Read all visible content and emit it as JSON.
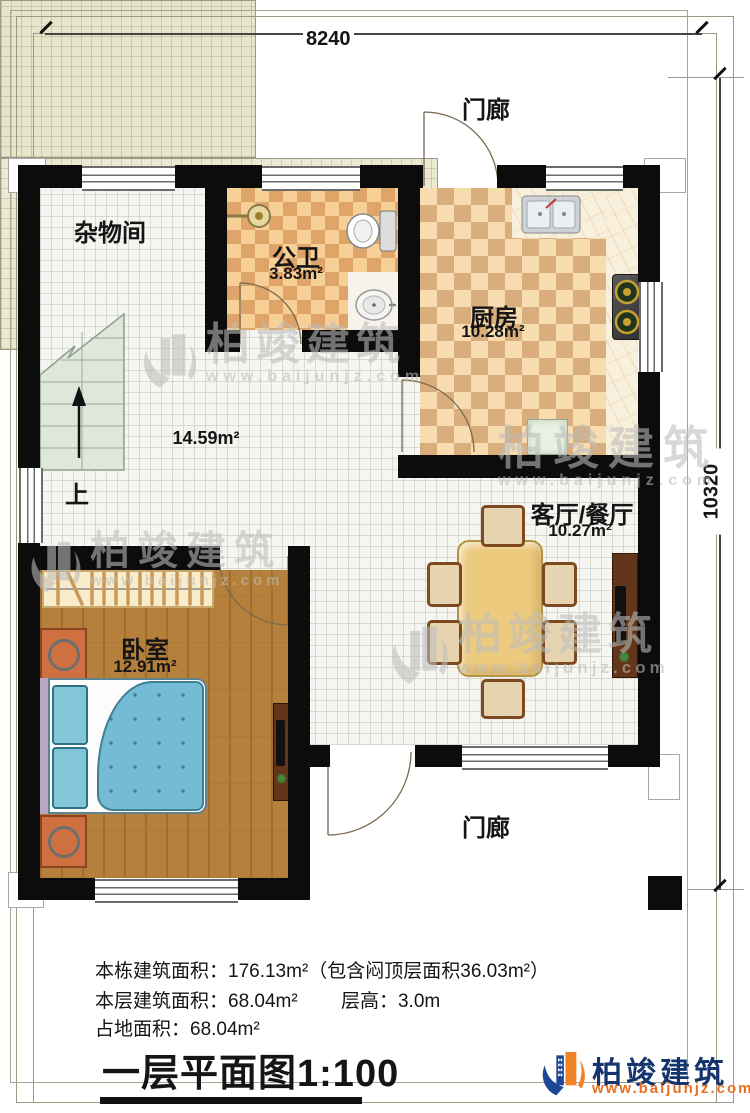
{
  "dimensions": {
    "width": "8240",
    "height": "10320"
  },
  "rooms": {
    "porch_top": {
      "name": "门廊"
    },
    "storage": {
      "name": "杂物间"
    },
    "bathroom": {
      "name": "公卫",
      "area": "3.83m²"
    },
    "kitchen": {
      "name": "厨房",
      "area": "10.28m²"
    },
    "hall": {
      "area": "14.59m²"
    },
    "living": {
      "name": "客厅/餐厅",
      "area": "10.27m²"
    },
    "bedroom": {
      "name": "卧室",
      "area": "12.91m²"
    },
    "porch_bottom": {
      "name": "门廊"
    },
    "stairs": {
      "direction": "上"
    }
  },
  "footer": {
    "line1": "本栋建筑面积：176.13m²（包含闷顶层面积36.03m²）",
    "line2a": "本层建筑面积：68.04m²",
    "line2b": "层高：3.0m",
    "line3": "占地面积：68.04m²",
    "plan_title": "一层平面图",
    "plan_scale": "1:100"
  },
  "brand": {
    "name": "柏竣建筑",
    "website": "www.baijunjz.com"
  },
  "watermark": {
    "name": "柏竣建筑",
    "website": "www.baijunjz.com"
  },
  "colors": {
    "wall": "#0c0c0c",
    "brand_blue": "#16356f",
    "brand_orange": "#e87020"
  }
}
